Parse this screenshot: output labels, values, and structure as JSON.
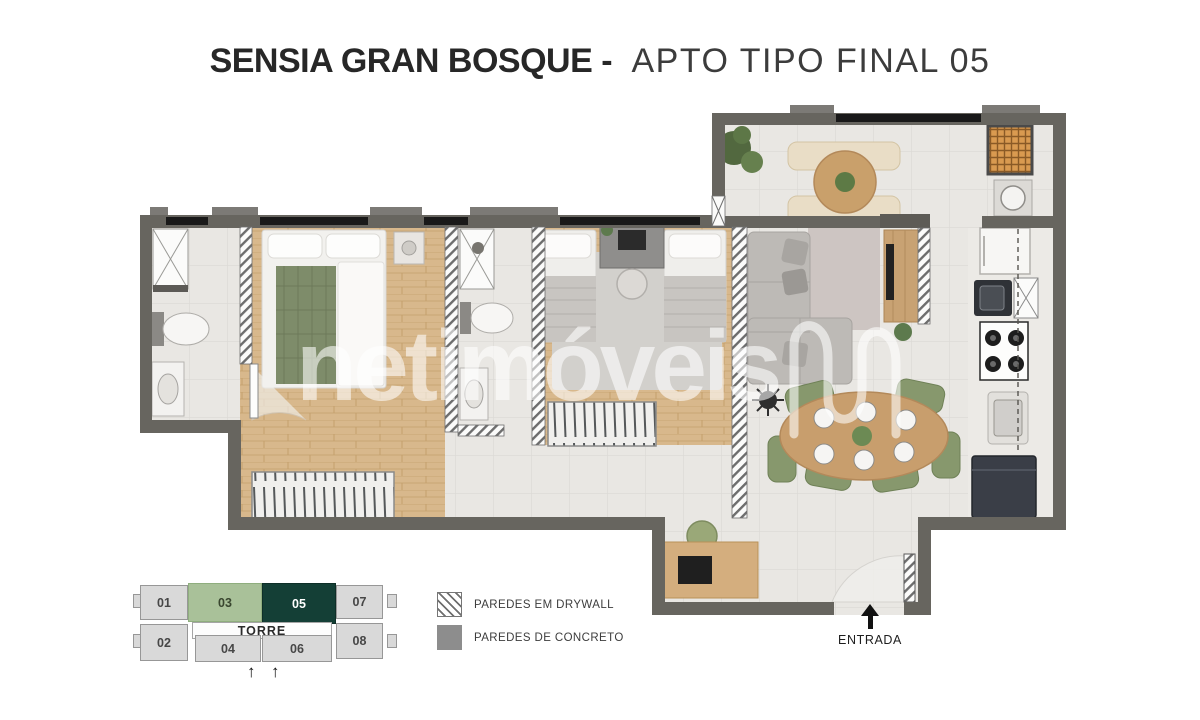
{
  "title": {
    "project": "SENSIA GRAN BOSQUE -",
    "unit": "APTO TIPO FINAL 05"
  },
  "watermark": {
    "text": "netimóveis",
    "logo": "netimoveis-n-logo"
  },
  "key_plan": {
    "tower_label": "TORRE",
    "arrow_symbol": "↑",
    "units": [
      {
        "label": "01",
        "highlight": "none"
      },
      {
        "label": "03",
        "highlight": "secondary"
      },
      {
        "label": "05",
        "highlight": "primary"
      },
      {
        "label": "07",
        "highlight": "none"
      },
      {
        "label": "02",
        "highlight": "none"
      },
      {
        "label": "04",
        "highlight": "none"
      },
      {
        "label": "06",
        "highlight": "none"
      },
      {
        "label": "08",
        "highlight": "none"
      }
    ]
  },
  "legend": {
    "items": [
      {
        "label": "PAREDES EM DRYWALL",
        "swatch": "drywall-hatch"
      },
      {
        "label": "PAREDES DE CONCRETO",
        "swatch": "concrete-solid"
      }
    ]
  },
  "entrance": {
    "label": "ENTRADA"
  },
  "colors": {
    "wall_concrete": "#67655f",
    "unit_highlight_primary": "#143f36",
    "unit_highlight_secondary": "#a9c199",
    "floor_tile": "#e9e7e3",
    "floor_wood": "#d8b88c",
    "dining_chair_green": "#87986d"
  }
}
